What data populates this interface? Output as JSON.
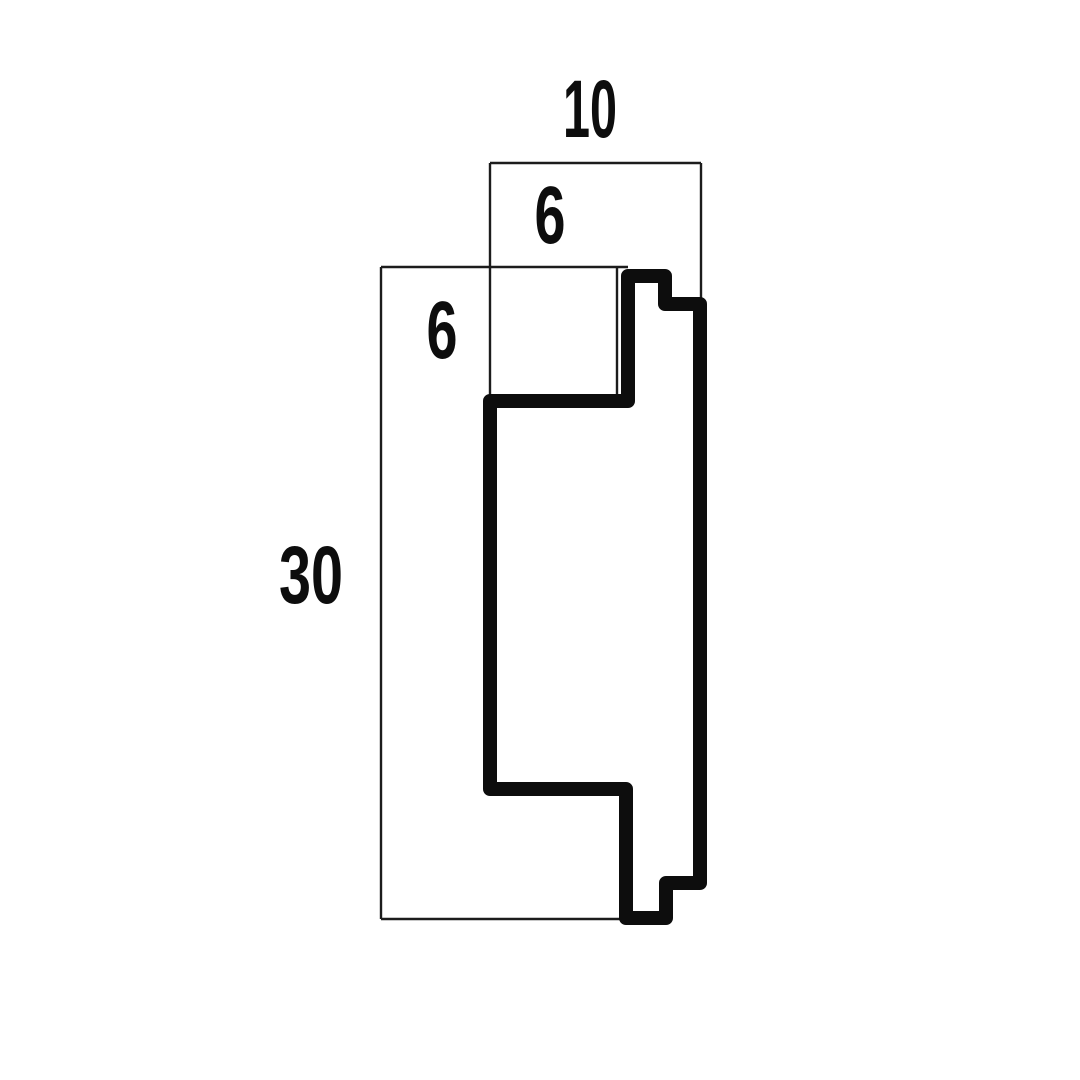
{
  "drawing": {
    "title": "profile-cross-section",
    "background_color": "#ffffff",
    "ink_color": "#0d0d0d",
    "thin_line_color": "#1c1c1c",
    "labels": {
      "top_width": "10",
      "top_depth": "6",
      "side_depth": "6",
      "side_height": "30"
    }
  }
}
